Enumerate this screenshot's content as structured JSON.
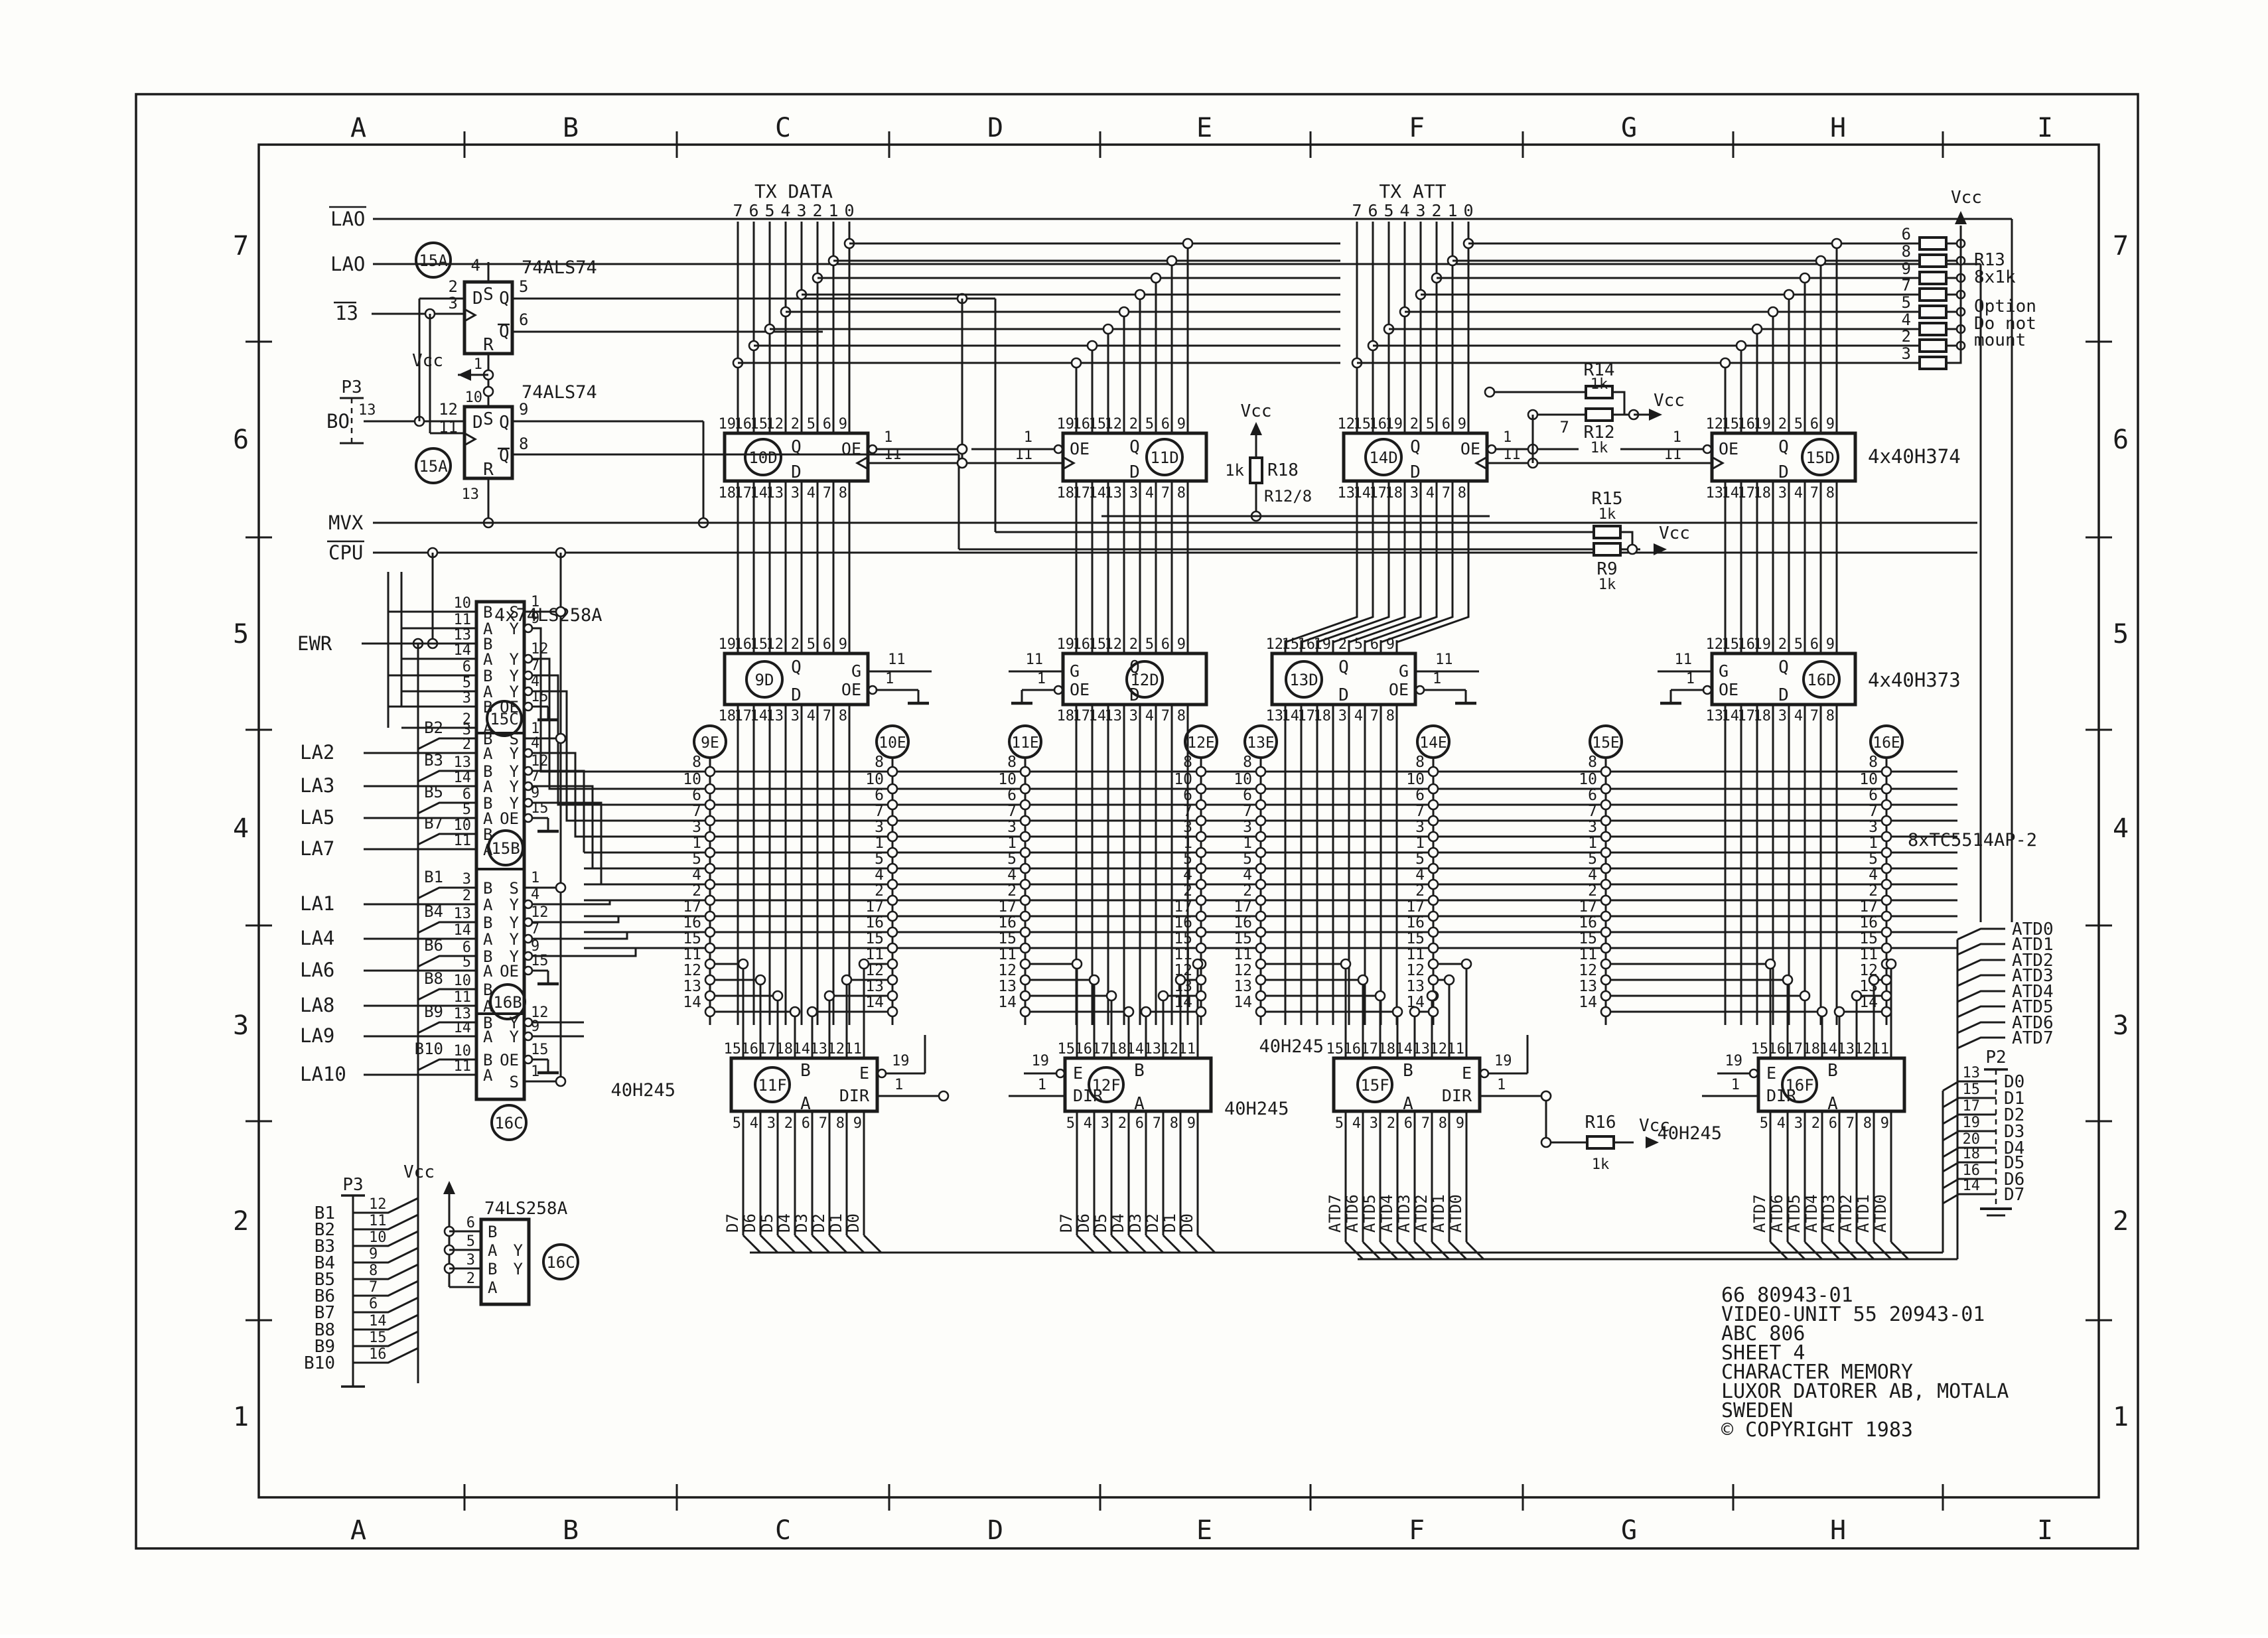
{
  "sheet": {
    "bg": "#fdfdfa",
    "ink": "#1b1b1b",
    "cols": [
      "A",
      "B",
      "C",
      "D",
      "E",
      "F",
      "G",
      "H",
      "I"
    ],
    "rows": [
      "7",
      "6",
      "5",
      "4",
      "3",
      "2",
      "1"
    ],
    "title": [
      "66 80943-01",
      "VIDEO-UNIT 55 20943-01",
      "ABC 806",
      "SHEET 4",
      "CHARACTER MEMORY",
      "LUXOR DATORER AB, MOTALA",
      "SWEDEN",
      "© COPYRIGHT 1983"
    ],
    "vcc": "Vcc"
  },
  "ff": {
    "part": "74ALS74",
    "ref": "15A",
    "u1": {
      "s": "S",
      "d": "D",
      "q": "Q",
      "qb": "Q",
      "r": "R",
      "pin_s": "4",
      "pin_d": "2",
      "pin_clk": "3",
      "pin_q": "5",
      "pin_qb": "6",
      "pin_r": "1"
    },
    "u2": {
      "s": "S",
      "d": "D",
      "q": "Q",
      "qb": "Q",
      "r": "R",
      "pin_s": "10",
      "pin_d": "12",
      "pin_clk": "11",
      "pin_q": "9",
      "pin_qb": "8",
      "pin_r": "13"
    },
    "sig_lao1": "LAO",
    "sig_lao2": "LAO",
    "sig_13": "13",
    "sig_bo": "BO",
    "sig_mvx": "MVX",
    "sig_cpu": "CPU",
    "p3": "P3",
    "p3_pin": "13"
  },
  "mux": {
    "part": "4x74LS258A",
    "sig_ewr": "EWR",
    "sections": [
      {
        "ref": "15C",
        "rows": [
          {
            "pin": "10",
            "port": "B"
          },
          {
            "pin": "11",
            "port": "A"
          },
          {
            "pin": "13",
            "port": "B"
          },
          {
            "pin": "14",
            "port": "A"
          },
          {
            "pin": "6",
            "port": "B"
          },
          {
            "pin": "5",
            "port": "A"
          },
          {
            "pin": "3",
            "port": "B"
          },
          {
            "pin": "2",
            "port": "A"
          }
        ],
        "outs": [
          {
            "port": "S",
            "pin": "1"
          },
          {
            "port": "Y",
            "pin": "9"
          },
          {
            "port": "Y",
            "pin": "12"
          },
          {
            "port": "Y",
            "pin": "7"
          },
          {
            "port": "Y",
            "pin": "4"
          },
          {
            "port": "OE",
            "pin": "15"
          }
        ]
      },
      {
        "ref": "15B",
        "rows": [
          {
            "pin": "3",
            "port": "B",
            "tag": "B2"
          },
          {
            "pin": "2",
            "port": "A",
            "sig": "LA2"
          },
          {
            "pin": "13",
            "port": "B",
            "tag": "B3"
          },
          {
            "pin": "14",
            "port": "A",
            "sig": "LA3"
          },
          {
            "pin": "6",
            "port": "B",
            "tag": "B5"
          },
          {
            "pin": "5",
            "port": "A",
            "sig": "LA5"
          },
          {
            "pin": "10",
            "port": "B",
            "tag": "B7"
          },
          {
            "pin": "11",
            "port": "A",
            "sig": "LA7"
          }
        ],
        "outs": [
          {
            "port": "S",
            "pin": "1"
          },
          {
            "port": "Y",
            "pin": "4"
          },
          {
            "port": "Y",
            "pin": "12"
          },
          {
            "port": "Y",
            "pin": "7"
          },
          {
            "port": "Y",
            "pin": "9"
          },
          {
            "port": "OE",
            "pin": "15"
          }
        ]
      },
      {
        "ref": "16B",
        "rows": [
          {
            "pin": "3",
            "port": "B",
            "tag": "B1"
          },
          {
            "pin": "2",
            "port": "A",
            "sig": "LA1"
          },
          {
            "pin": "13",
            "port": "B",
            "tag": "B4"
          },
          {
            "pin": "14",
            "port": "A",
            "sig": "LA4"
          },
          {
            "pin": "6",
            "port": "B",
            "tag": "B6"
          },
          {
            "pin": "5",
            "port": "A",
            "sig": "LA6"
          },
          {
            "pin": "10",
            "port": "B",
            "tag": "B8"
          },
          {
            "pin": "11",
            "port": "A",
            "sig": "LA8"
          }
        ],
        "outs": [
          {
            "port": "S",
            "pin": "1"
          },
          {
            "port": "Y",
            "pin": "4"
          },
          {
            "port": "Y",
            "pin": "12"
          },
          {
            "port": "Y",
            "pin": "7"
          },
          {
            "port": "Y",
            "pin": "9"
          },
          {
            "port": "OE",
            "pin": "15"
          }
        ]
      },
      {
        "ref": "16C",
        "rows": [
          {
            "pin": "13",
            "port": "B",
            "tag": "B9"
          },
          {
            "pin": "14",
            "port": "A",
            "sig": "LA9"
          },
          {
            "pin": "10",
            "port": "B",
            "tag": "B10"
          },
          {
            "pin": "11",
            "port": "A",
            "sig": "LA10"
          }
        ],
        "outs": [
          {
            "port": "Y",
            "pin": "12"
          },
          {
            "port": "Y",
            "pin": "9"
          },
          {
            "port": "OE",
            "pin": "15"
          },
          {
            "port": "S",
            "pin": "1"
          }
        ]
      }
    ]
  },
  "latch374": {
    "part": "4x40H374",
    "q": "Q",
    "d": "D",
    "oe": "OE",
    "oe_pin": "1",
    "clk_pin": "11",
    "ics": [
      {
        "ref": "10D",
        "top": [
          "19",
          "16",
          "15",
          "12",
          "2",
          "5",
          "6",
          "9"
        ],
        "bot": [
          "18",
          "17",
          "14",
          "13",
          "3",
          "4",
          "7",
          "8"
        ]
      },
      {
        "ref": "11D",
        "top": [
          "19",
          "16",
          "15",
          "12",
          "2",
          "5",
          "6",
          "9"
        ],
        "bot": [
          "18",
          "17",
          "14",
          "13",
          "3",
          "4",
          "7",
          "8"
        ]
      },
      {
        "ref": "14D",
        "top": [
          "12",
          "15",
          "16",
          "19",
          "2",
          "5",
          "6",
          "9"
        ],
        "bot": [
          "13",
          "14",
          "17",
          "18",
          "3",
          "4",
          "7",
          "8"
        ]
      },
      {
        "ref": "15D",
        "top": [
          "12",
          "15",
          "16",
          "19",
          "2",
          "5",
          "6",
          "9"
        ],
        "bot": [
          "13",
          "14",
          "17",
          "18",
          "3",
          "4",
          "7",
          "8"
        ]
      }
    ]
  },
  "latch373": {
    "part": "4x40H373",
    "q": "Q",
    "d": "D",
    "g": "G",
    "g_pin": "11",
    "oe": "OE",
    "oe_pin": "1",
    "ics": [
      {
        "ref": "9D",
        "top": [
          "19",
          "16",
          "15",
          "12",
          "2",
          "5",
          "6",
          "9"
        ],
        "bot": [
          "18",
          "17",
          "14",
          "13",
          "3",
          "4",
          "7",
          "8"
        ]
      },
      {
        "ref": "12D",
        "top": [
          "19",
          "16",
          "15",
          "12",
          "2",
          "5",
          "6",
          "9"
        ],
        "bot": [
          "18",
          "17",
          "14",
          "13",
          "3",
          "4",
          "7",
          "8"
        ]
      },
      {
        "ref": "13D",
        "top": [
          "12",
          "15",
          "16",
          "19",
          "2",
          "5",
          "6",
          "9"
        ],
        "bot": [
          "13",
          "14",
          "17",
          "18",
          "3",
          "4",
          "7",
          "8"
        ]
      },
      {
        "ref": "16D",
        "top": [
          "12",
          "15",
          "16",
          "19",
          "2",
          "5",
          "6",
          "9"
        ],
        "bot": [
          "13",
          "14",
          "17",
          "18",
          "3",
          "4",
          "7",
          "8"
        ]
      }
    ]
  },
  "ram": {
    "part": "8xTC5514AP-2",
    "cols": [
      "9E",
      "10E",
      "11E",
      "12E",
      "13E",
      "14E",
      "15E",
      "16E"
    ],
    "addr_pins": [
      "8",
      "10",
      "6",
      "7",
      "3",
      "1",
      "5",
      "4",
      "2",
      "17",
      "16",
      "15"
    ],
    "data_pins": [
      "11",
      "12",
      "13",
      "14"
    ]
  },
  "xcvr": {
    "part": "40H245",
    "b": "B",
    "a": "A",
    "e": "E",
    "e_pin": "19",
    "dir": "DIR",
    "dir_pin": "1",
    "top": [
      "15",
      "16",
      "17",
      "18",
      "14",
      "13",
      "12",
      "11"
    ],
    "bot": [
      "5",
      "4",
      "3",
      "2",
      "6",
      "7",
      "8",
      "9"
    ],
    "ics": [
      {
        "ref": "11F",
        "bus": [
          "D7",
          "D6",
          "D5",
          "D4",
          "D3",
          "D2",
          "D1",
          "D0"
        ]
      },
      {
        "ref": "12F",
        "bus": [
          "D7",
          "D6",
          "D5",
          "D4",
          "D3",
          "D2",
          "D1",
          "D0"
        ]
      },
      {
        "ref": "15F",
        "bus": [
          "ATD7",
          "ATD6",
          "ATD5",
          "ATD4",
          "ATD3",
          "ATD2",
          "ATD1",
          "ATD0"
        ]
      },
      {
        "ref": "16F",
        "bus": [
          "ATD7",
          "ATD6",
          "ATD5",
          "ATD4",
          "ATD3",
          "ATD2",
          "ATD1",
          "ATD0"
        ]
      }
    ]
  },
  "tx_data": {
    "label": "TX DATA",
    "bits": [
      "7",
      "6",
      "5",
      "4",
      "3",
      "2",
      "1",
      "0"
    ]
  },
  "tx_att": {
    "label": "TX ATT",
    "bits": [
      "7",
      "6",
      "5",
      "4",
      "3",
      "2",
      "1",
      "0"
    ]
  },
  "atd": {
    "labels": [
      "ATD0",
      "ATD1",
      "ATD2",
      "ATD3",
      "ATD4",
      "ATD5",
      "ATD6",
      "ATD7"
    ]
  },
  "res": {
    "r13": {
      "name": "R13",
      "value": "8x1k",
      "pins": [
        "6",
        "8",
        "9",
        "7",
        "5",
        "4",
        "2",
        "3"
      ],
      "note1": "Option",
      "note2": "Do not",
      "note3": "mount"
    },
    "r14": {
      "name": "R14",
      "value": "1k"
    },
    "r12": {
      "name": "R12",
      "value": "1k",
      "pin": "7"
    },
    "r15": {
      "name": "R15",
      "value": "1k"
    },
    "r9": {
      "name": "R9",
      "value": "1k"
    },
    "r16": {
      "name": "R16",
      "value": "1k"
    },
    "r18": {
      "name": "R18",
      "value": "1k",
      "note": "R12/8"
    }
  },
  "p3": {
    "label": "P3",
    "rows": [
      {
        "sig": "B1",
        "pin": "12"
      },
      {
        "sig": "B2",
        "pin": "11"
      },
      {
        "sig": "B3",
        "pin": "10"
      },
      {
        "sig": "B4",
        "pin": "9"
      },
      {
        "sig": "B5",
        "pin": "8"
      },
      {
        "sig": "B6",
        "pin": "7"
      },
      {
        "sig": "B7",
        "pin": "6"
      },
      {
        "sig": "B8",
        "pin": "14"
      },
      {
        "sig": "B9",
        "pin": "15"
      },
      {
        "sig": "B10",
        "pin": "16"
      }
    ]
  },
  "p2": {
    "label": "P2",
    "rows": [
      {
        "pin": "13",
        "sig": "D0"
      },
      {
        "pin": "15",
        "sig": "D1"
      },
      {
        "pin": "17",
        "sig": "D2"
      },
      {
        "pin": "19",
        "sig": "D3"
      },
      {
        "pin": "20",
        "sig": "D4"
      },
      {
        "pin": "18",
        "sig": "D5"
      },
      {
        "pin": "16",
        "sig": "D6"
      },
      {
        "pin": "14",
        "sig": "D7"
      }
    ]
  },
  "mux2": {
    "part": "74LS258A",
    "ref": "16C",
    "rows": [
      {
        "pin": "6",
        "port": "B"
      },
      {
        "pin": "5",
        "port": "A"
      },
      {
        "pin": "3",
        "port": "B"
      },
      {
        "pin": "2",
        "port": "A"
      }
    ],
    "outs": [
      "Y",
      "Y"
    ]
  }
}
